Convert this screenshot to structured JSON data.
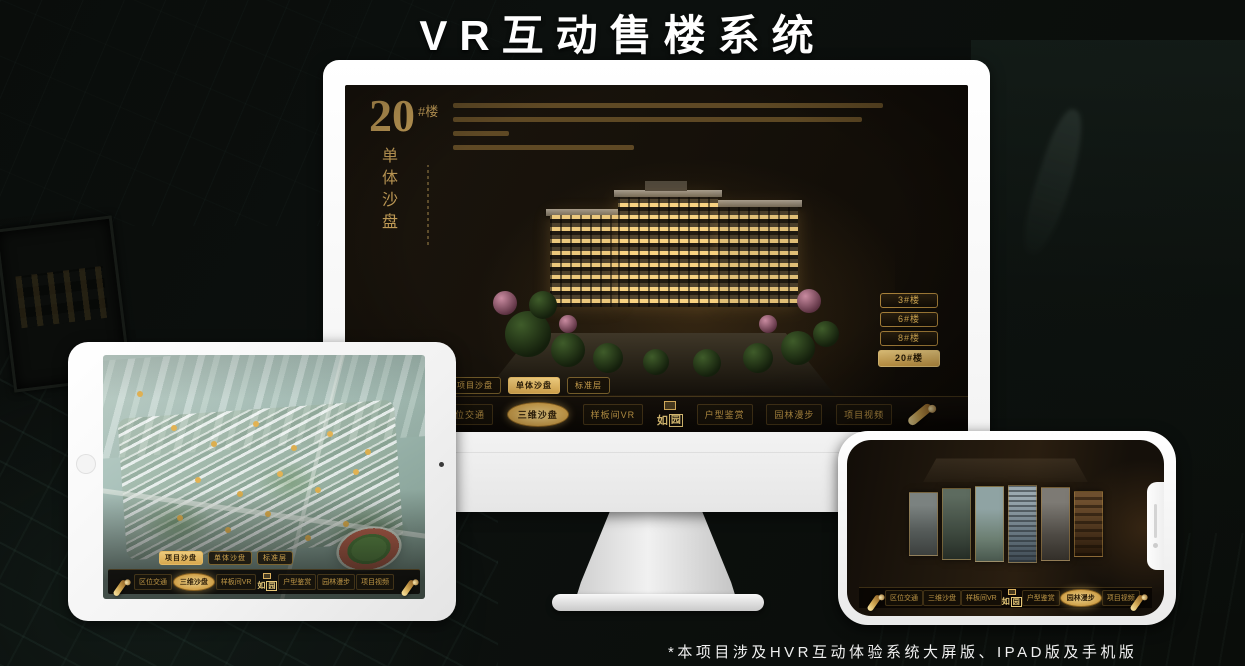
{
  "page": {
    "title": "VR互动售楼系统",
    "footnote": "*本项目涉及HVR互动体验系统大屏版、IPAD版及手机版"
  },
  "colors": {
    "gold": "#c89b4e",
    "gold_active": "#e3b964",
    "screen_bg": "#161009",
    "page_bg": "#0a0c0a"
  },
  "brand": {
    "first": "如",
    "second": "园"
  },
  "nav": {
    "items": [
      {
        "label": "区位交通"
      },
      {
        "label": "三维沙盘"
      },
      {
        "label": "样板间VR"
      },
      {
        "label": "户型鉴赏"
      },
      {
        "label": "园林漫步"
      },
      {
        "label": "项目视频"
      }
    ]
  },
  "sub_tabs": [
    {
      "label": "项目沙盘"
    },
    {
      "label": "单体沙盘"
    },
    {
      "label": "标准层"
    }
  ],
  "monitor": {
    "headline_number": "20",
    "headline_unit": "#楼",
    "headline_caption": "单体沙盘",
    "floor_buttons": [
      {
        "label": "3#楼"
      },
      {
        "label": "6#楼"
      },
      {
        "label": "8#楼"
      },
      {
        "label": "20#楼"
      }
    ]
  }
}
